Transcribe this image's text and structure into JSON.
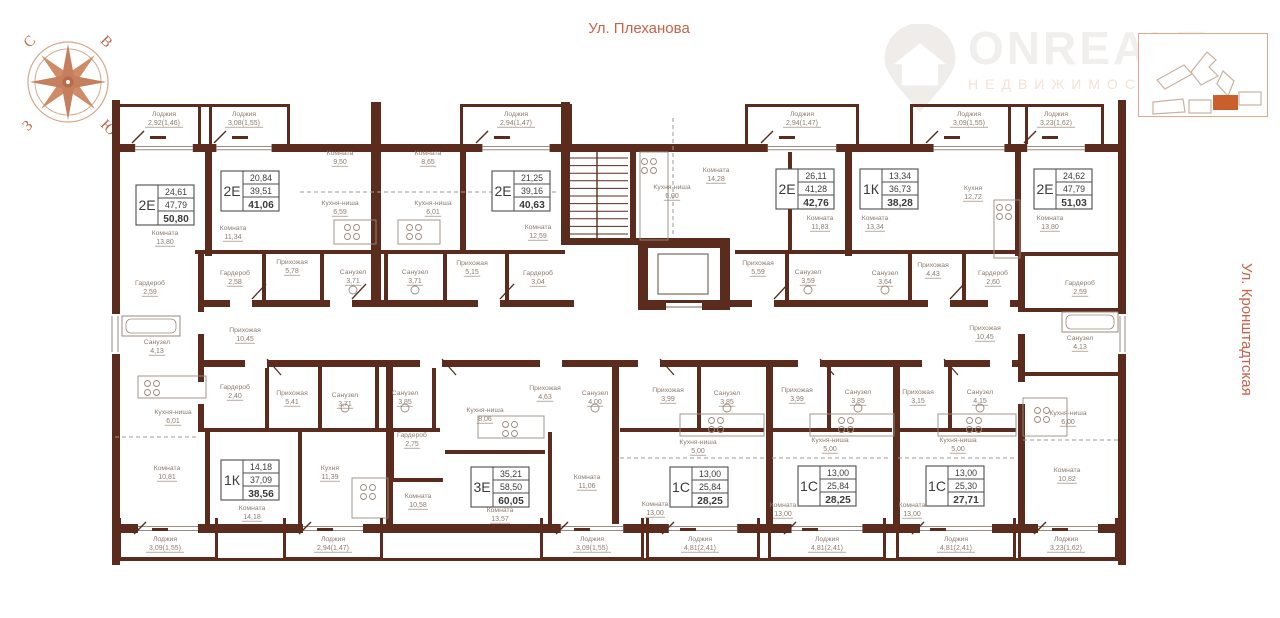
{
  "streets": {
    "top": "Ул. Плеханова",
    "right": "Ул. Кронштадтская"
  },
  "compass": {
    "north": "С",
    "east": "В",
    "west": "З",
    "south": "Ю"
  },
  "logo": {
    "name": "ONREALT",
    "subtitle": "НЕДВИЖИМОСТЬ"
  },
  "colors": {
    "wall": "#5b2c1d",
    "accent": "#cb6149",
    "room_label": "#8d7b6e",
    "apt_text": "#3c3c3c",
    "apt_border": "#4d4d4d",
    "fixture": "#9b8a7e",
    "locator_highlight": "#c95f2b"
  },
  "apartments": [
    {
      "type": "2Е",
      "living": "24,61",
      "area": "47,79",
      "total": "50,80",
      "x": 165,
      "y": 205
    },
    {
      "type": "2Е",
      "living": "20,84",
      "area": "39,51",
      "total": "41,06",
      "x": 250,
      "y": 191
    },
    {
      "type": "2Е",
      "living": "21,25",
      "area": "39,16",
      "total": "40,63",
      "x": 521,
      "y": 191
    },
    {
      "type": "2Е",
      "living": "26,11",
      "area": "41,28",
      "total": "42,76",
      "x": 805,
      "y": 189
    },
    {
      "type": "1К",
      "living": "13,34",
      "area": "36,73",
      "total": "38,28",
      "x": 889,
      "y": 189
    },
    {
      "type": "2Е",
      "living": "24,62",
      "area": "47,79",
      "total": "51,03",
      "x": 1063,
      "y": 189
    },
    {
      "type": "1К",
      "living": "14,18",
      "area": "37,09",
      "total": "38,56",
      "x": 250,
      "y": 480
    },
    {
      "type": "3Е",
      "living": "35,21",
      "area": "58,50",
      "total": "60,05",
      "x": 500,
      "y": 487
    },
    {
      "type": "1С",
      "living": "13,00",
      "area": "25,84",
      "total": "28,25",
      "x": 699,
      "y": 487
    },
    {
      "type": "1С",
      "living": "13,00",
      "area": "25,84",
      "total": "28,25",
      "x": 827,
      "y": 486
    },
    {
      "type": "1С",
      "living": "13,00",
      "area": "25,30",
      "total": "27,71",
      "x": 955,
      "y": 486
    }
  ],
  "rooms": [
    {
      "name": "Комната",
      "area": "9,50",
      "x": 340,
      "y": 155
    },
    {
      "name": "Комната",
      "area": "8,65",
      "x": 428,
      "y": 155
    },
    {
      "name": "Комната",
      "area": "14,28",
      "x": 716,
      "y": 172
    },
    {
      "name": "Кухня-ниша",
      "area": "6,59",
      "x": 340,
      "y": 205
    },
    {
      "name": "Кухня-ниша",
      "area": "6,01",
      "x": 433,
      "y": 205
    },
    {
      "name": "Кухня-ниша",
      "area": "6,00",
      "x": 672,
      "y": 189
    },
    {
      "name": "Кухня",
      "area": "12,72",
      "x": 973,
      "y": 190
    },
    {
      "name": "Комната",
      "area": "13,80",
      "x": 165,
      "y": 235
    },
    {
      "name": "Комната",
      "area": "11,34",
      "x": 233,
      "y": 230
    },
    {
      "name": "Комната",
      "area": "12,59",
      "x": 538,
      "y": 229
    },
    {
      "name": "Комната",
      "area": "11,83",
      "x": 820,
      "y": 220
    },
    {
      "name": "Комната",
      "area": "13,34",
      "x": 875,
      "y": 220
    },
    {
      "name": "Комната",
      "area": "13,80",
      "x": 1050,
      "y": 220
    },
    {
      "name": "Прихожая",
      "area": "5,78",
      "x": 292,
      "y": 264
    },
    {
      "name": "Прихожая",
      "area": "5,15",
      "x": 472,
      "y": 265
    },
    {
      "name": "Прихожая",
      "area": "5,59",
      "x": 758,
      "y": 265
    },
    {
      "name": "Прихожая",
      "area": "4,43",
      "x": 933,
      "y": 267
    },
    {
      "name": "Гардероб",
      "area": "2,58",
      "x": 235,
      "y": 275
    },
    {
      "name": "Гардероб",
      "area": "3,04",
      "x": 538,
      "y": 275
    },
    {
      "name": "Гардероб",
      "area": "2,60",
      "x": 993,
      "y": 275
    },
    {
      "name": "Санузел",
      "area": "3,71",
      "x": 353,
      "y": 274
    },
    {
      "name": "Санузел",
      "area": "3,71",
      "x": 415,
      "y": 274
    },
    {
      "name": "Санузел",
      "area": "3,59",
      "x": 808,
      "y": 274
    },
    {
      "name": "Санузел",
      "area": "3,64",
      "x": 885,
      "y": 275
    },
    {
      "name": "Гардероб",
      "area": "2,59",
      "x": 150,
      "y": 285
    },
    {
      "name": "Гардероб",
      "area": "2,59",
      "x": 1080,
      "y": 285
    },
    {
      "name": "Санузел",
      "area": "4,13",
      "x": 157,
      "y": 344
    },
    {
      "name": "Санузел",
      "area": "4,13",
      "x": 1080,
      "y": 340
    },
    {
      "name": "Прихожая",
      "area": "10,45",
      "x": 245,
      "y": 332
    },
    {
      "name": "Прихожая",
      "area": "10,45",
      "x": 985,
      "y": 330
    },
    {
      "name": "Гардероб",
      "area": "2,40",
      "x": 235,
      "y": 389
    },
    {
      "name": "Прихожая",
      "area": "5,41",
      "x": 292,
      "y": 395
    },
    {
      "name": "Санузел",
      "area": "3,71",
      "x": 345,
      "y": 397
    },
    {
      "name": "Санузел",
      "area": "3,85",
      "x": 405,
      "y": 395
    },
    {
      "name": "Кухня-ниша",
      "area": "6,01",
      "x": 173,
      "y": 414
    },
    {
      "name": "Кухня-ниша",
      "area": "6,00",
      "x": 1068,
      "y": 415
    },
    {
      "name": "Прихожая",
      "area": "4,63",
      "x": 545,
      "y": 390
    },
    {
      "name": "Санузел",
      "area": "4,00",
      "x": 595,
      "y": 395
    },
    {
      "name": "Прихожая",
      "area": "3,99",
      "x": 668,
      "y": 392
    },
    {
      "name": "Санузел",
      "area": "3,85",
      "x": 727,
      "y": 395
    },
    {
      "name": "Прихожая",
      "area": "3,99",
      "x": 797,
      "y": 392
    },
    {
      "name": "Санузел",
      "area": "3,85",
      "x": 858,
      "y": 394
    },
    {
      "name": "Прихожая",
      "area": "3,15",
      "x": 918,
      "y": 394
    },
    {
      "name": "Санузел",
      "area": "4,15",
      "x": 980,
      "y": 394
    },
    {
      "name": "Гардероб",
      "area": "2,75",
      "x": 412,
      "y": 437
    },
    {
      "name": "Кухня-ниша",
      "area": "8,06",
      "x": 485,
      "y": 412
    },
    {
      "name": "Кухня-ниша",
      "area": "5,00",
      "x": 698,
      "y": 444
    },
    {
      "name": "Кухня-ниша",
      "area": "5,00",
      "x": 830,
      "y": 442
    },
    {
      "name": "Кухня-ниша",
      "area": "5,00",
      "x": 958,
      "y": 442
    },
    {
      "name": "Комната",
      "area": "10,81",
      "x": 167,
      "y": 470
    },
    {
      "name": "Кухня",
      "area": "11,39",
      "x": 330,
      "y": 470
    },
    {
      "name": "Комната",
      "area": "14,18",
      "x": 252,
      "y": 510
    },
    {
      "name": "Комната",
      "area": "10,58",
      "x": 418,
      "y": 498
    },
    {
      "name": "Комната",
      "area": "13,57",
      "x": 500,
      "y": 512
    },
    {
      "name": "Комната",
      "area": "11,06",
      "x": 587,
      "y": 479
    },
    {
      "name": "Комната",
      "area": "13,00",
      "x": 655,
      "y": 506
    },
    {
      "name": "Комната",
      "area": "13,00",
      "x": 783,
      "y": 507
    },
    {
      "name": "Комната",
      "area": "13,00",
      "x": 912,
      "y": 507
    },
    {
      "name": "Комната",
      "area": "10,82",
      "x": 1067,
      "y": 472
    },
    {
      "name": "Лоджия",
      "area": "2,92(1,46)",
      "x": 164,
      "y": 116
    },
    {
      "name": "Лоджия",
      "area": "3,08(1,55)",
      "x": 244,
      "y": 116
    },
    {
      "name": "Лоджия",
      "area": "2,94(1,47)",
      "x": 516,
      "y": 116
    },
    {
      "name": "Лоджия",
      "area": "2,94(1,47)",
      "x": 802,
      "y": 116
    },
    {
      "name": "Лоджия",
      "area": "3,09(1,55)",
      "x": 969,
      "y": 116
    },
    {
      "name": "Лоджия",
      "area": "3,23(1,62)",
      "x": 1056,
      "y": 116
    },
    {
      "name": "Лоджия",
      "area": "3,09(1,55)",
      "x": 165,
      "y": 541
    },
    {
      "name": "Лоджия",
      "area": "2,94(1,47)",
      "x": 333,
      "y": 541
    },
    {
      "name": "Лоджия",
      "area": "3,09(1,55)",
      "x": 592,
      "y": 541
    },
    {
      "name": "Лоджия",
      "area": "4,81(2,41)",
      "x": 700,
      "y": 541
    },
    {
      "name": "Лоджия",
      "area": "4,81(2,41)",
      "x": 827,
      "y": 541
    },
    {
      "name": "Лоджия",
      "area": "4,81(2,41)",
      "x": 956,
      "y": 541
    },
    {
      "name": "Лоджия",
      "area": "3,23(1,62)",
      "x": 1066,
      "y": 541
    }
  ]
}
